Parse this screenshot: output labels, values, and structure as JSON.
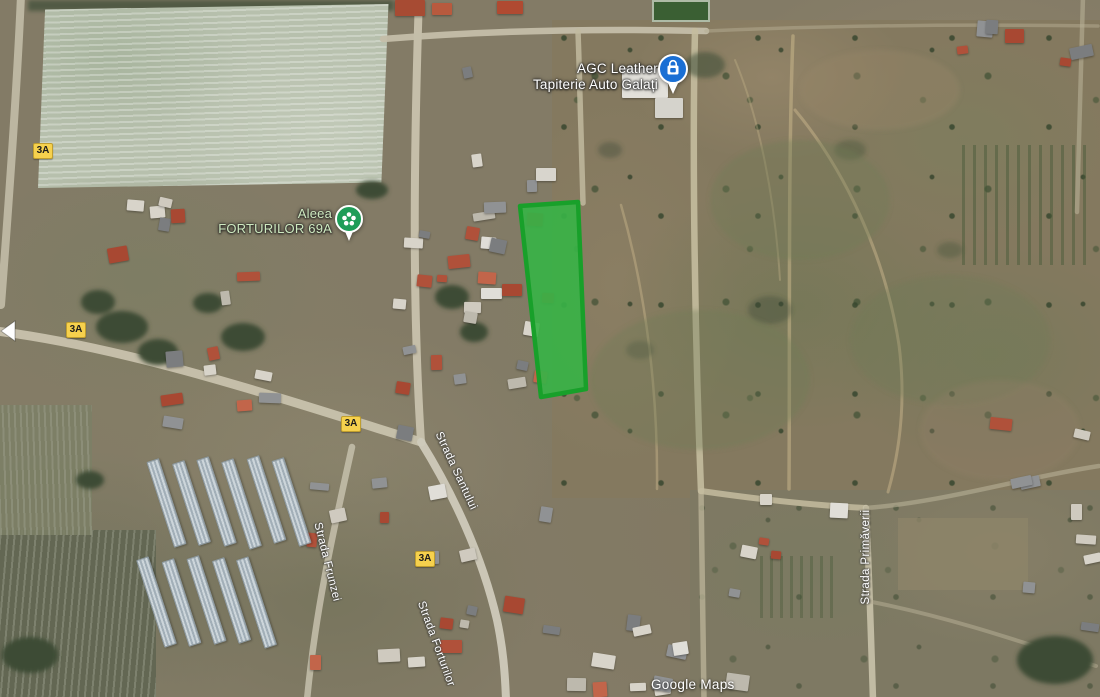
{
  "map": {
    "watermark": "Google Maps",
    "route_badge_label": "3A",
    "pois": [
      {
        "line1": "AGC Leather",
        "line2": "Tapiterie Auto Galați",
        "icon": "shopping-bag-pin",
        "pin_color": "#1a6fd4"
      },
      {
        "line1": "Aleea",
        "line2": "FORTURILOR 69A",
        "icon": "park-flower-pin",
        "pin_color": "#1f9d58",
        "text_color": "#cfeac0"
      }
    ],
    "streets": [
      {
        "name": "Strada Santului"
      },
      {
        "name": "Strada Frunzei"
      },
      {
        "name": "Strada Forturilor"
      },
      {
        "name": "Strada Primăverii"
      }
    ],
    "highlight_parcel": {
      "label": "highlighted land parcel",
      "fill": "#38b246",
      "stroke": "#18a02a",
      "fill_opacity": "0.92"
    }
  }
}
